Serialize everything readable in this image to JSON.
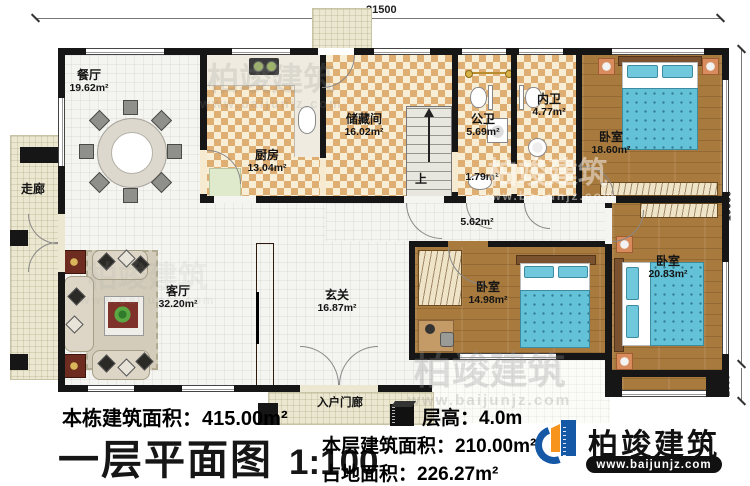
{
  "dimensions": {
    "top": "21500",
    "right": "10000",
    "right_small": "1000"
  },
  "rooms": {
    "dining": {
      "name": "餐厅",
      "area": "19.62m²"
    },
    "corridor": {
      "name": "走廊"
    },
    "kitchen": {
      "name": "厨房",
      "area": "13.04m²"
    },
    "storage": {
      "name": "储藏间",
      "area": "16.02m²"
    },
    "stairs": {
      "label": "上"
    },
    "public_bath": {
      "name": "公卫",
      "area": "5.69m²"
    },
    "inner_bath": {
      "name": "内卫",
      "area": "4.77m²"
    },
    "basin_nook": {
      "area": "1.79m²"
    },
    "hallway": {
      "area": "5.62m²"
    },
    "bedroom_top": {
      "name": "卧室",
      "area": "18.60m²"
    },
    "bedroom_right": {
      "name": "卧室",
      "area": "20.83m²"
    },
    "bedroom_mid": {
      "name": "卧室",
      "area": "14.98m²"
    },
    "living": {
      "name": "客厅",
      "area": "32.20m²"
    },
    "foyer": {
      "name": "玄关",
      "area": "16.87m²"
    },
    "porch": {
      "name": "入户门廊"
    }
  },
  "footer": {
    "total_area": "本栋建筑面积：415.00m²",
    "title": "一层平面图",
    "scale": "1:100",
    "floor_height": "层高：4.0m",
    "floor_area": "本层建筑面积：210.00m²",
    "footprint": "占地面积：226.27m²"
  },
  "brand": {
    "name": "柏竣建筑",
    "url": "www.baijunjz.com"
  },
  "colors": {
    "brand_blue": "#1558a6",
    "brand_orange": "#f7941d",
    "wall": "#161616",
    "bed_teal": "#64c2d8"
  }
}
